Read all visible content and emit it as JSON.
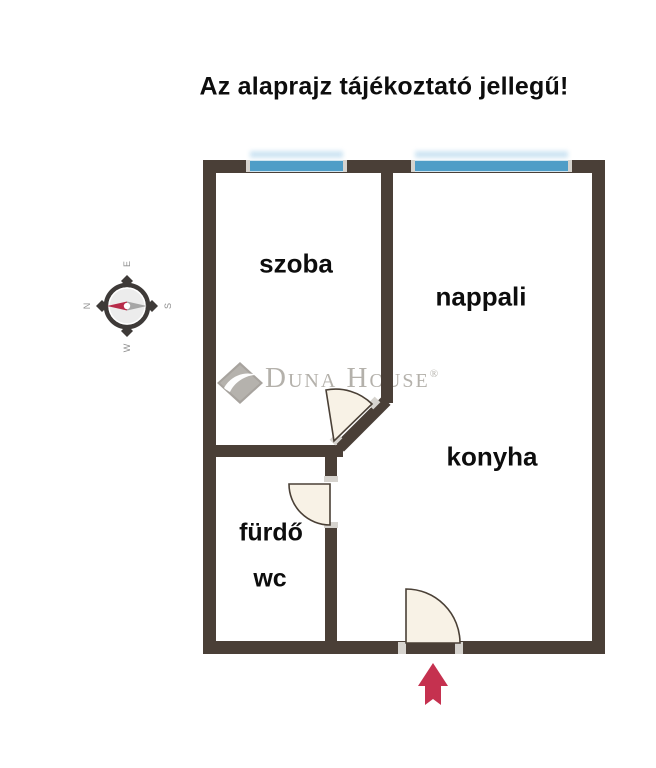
{
  "title": "Az alaprajz tájékoztató jellegű!",
  "rooms": {
    "szoba": "szoba",
    "nappali": "nappali",
    "konyha": "konyha",
    "furdo": "fürdő",
    "wc": "wc"
  },
  "compass": {
    "north": "N",
    "east": "E",
    "south": "S",
    "west": "W"
  },
  "watermark": {
    "brand": "Duna House",
    "registered_mark": "®"
  },
  "colors": {
    "wall": "#4a3f37",
    "window": "#4f9dc7",
    "door": "#f8f2e6",
    "door-line": "#4a4036",
    "jamb": "#d6d3ce",
    "arrow": "#c5314f",
    "needle-red": "#b72b49",
    "needle-gray": "#a6a6a6",
    "watermark": "#b4b1ab"
  }
}
